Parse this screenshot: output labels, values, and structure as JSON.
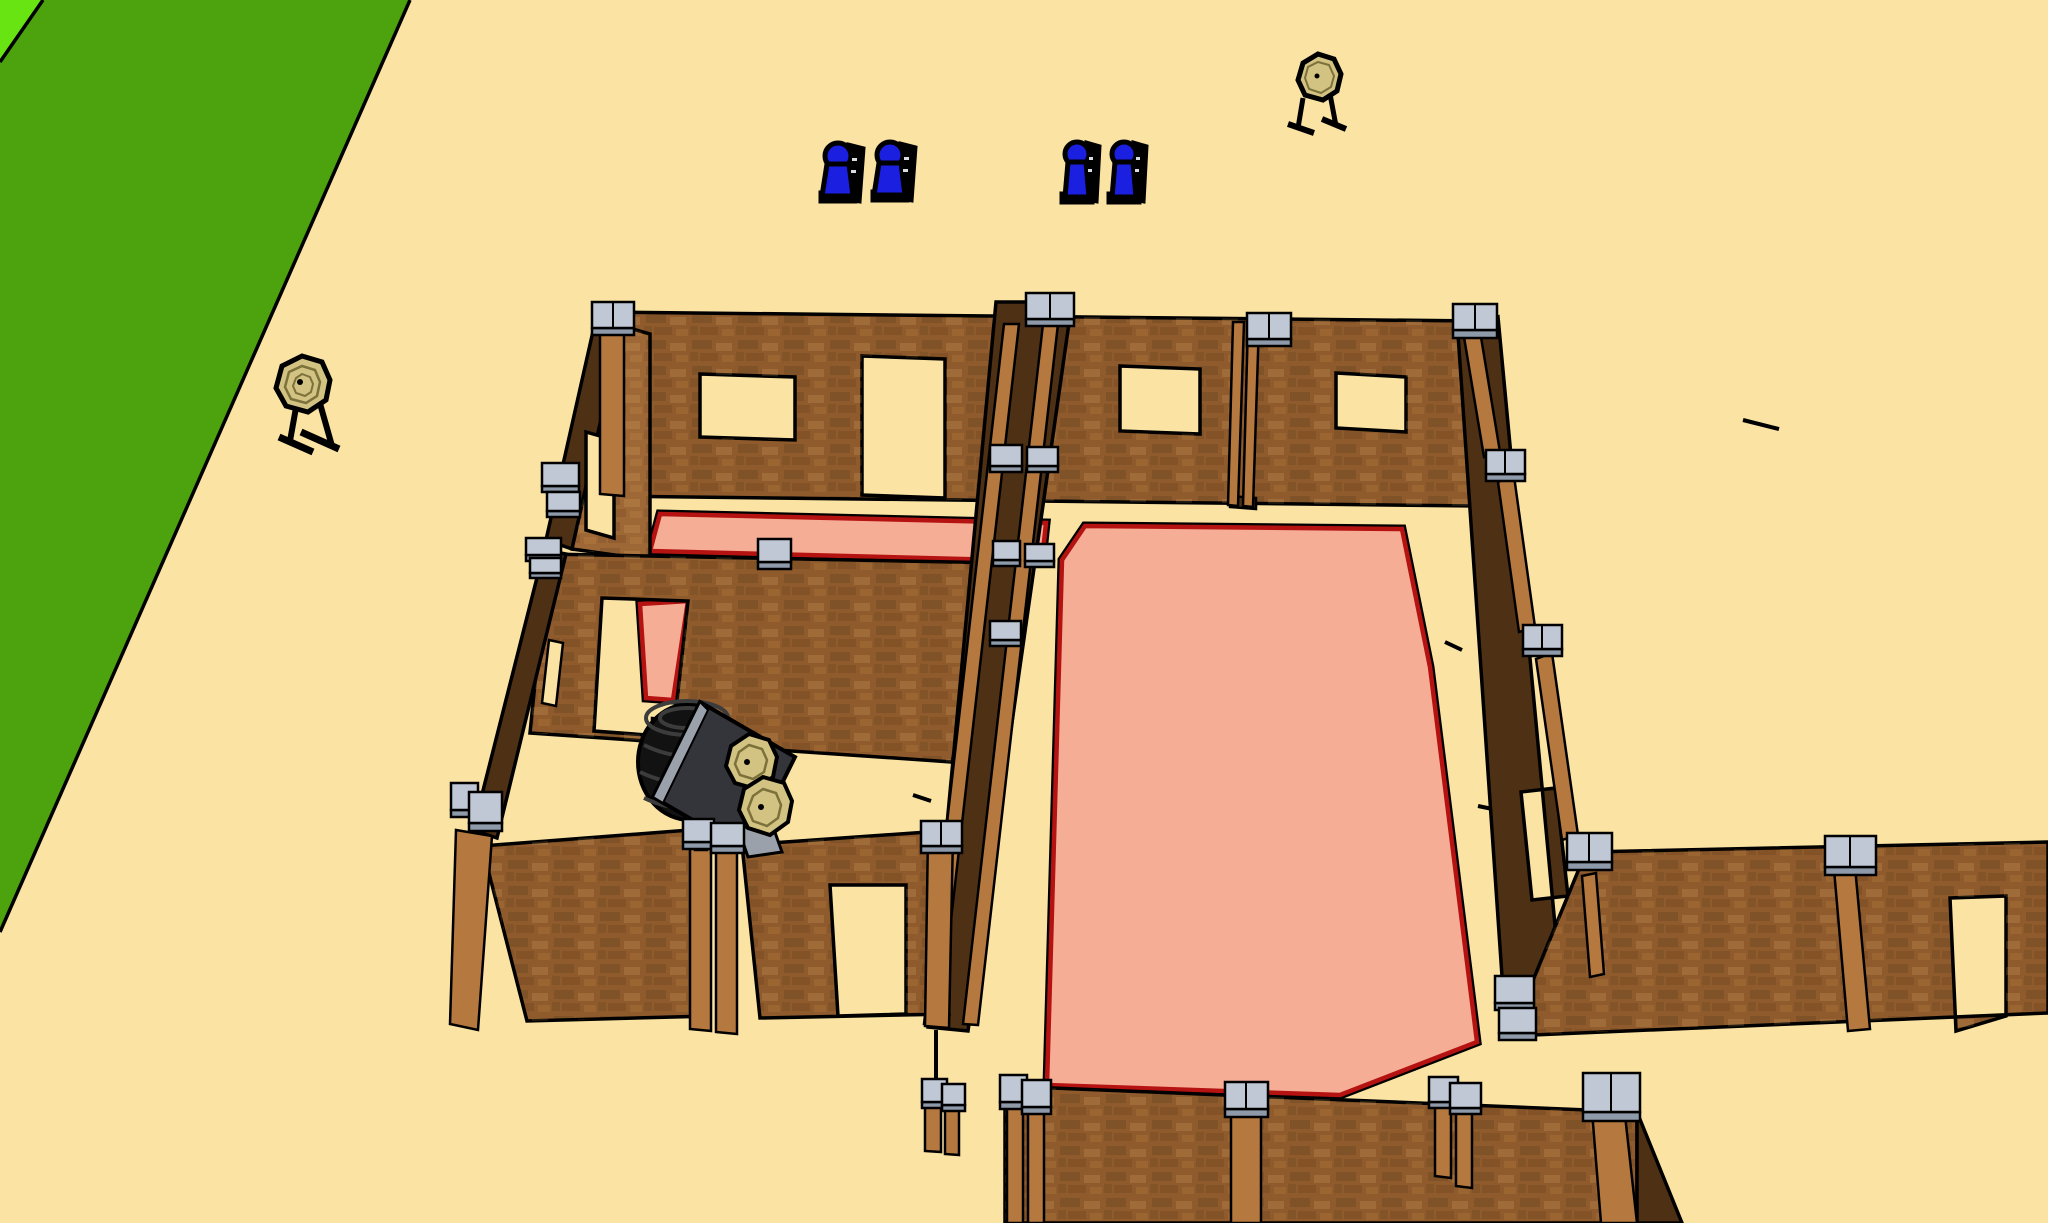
{
  "viewport": {
    "kind": "3d-model-viewport",
    "description": "Overhead perspective 3D model of a pistol shooting stage: wooden walled rooms with window and door openings, steel-capped posts, pink fault-line floor zones outlined in red, two paper targets on stands, four blue steel poppers, a tire stack with a leaning panel holding two paper targets, and a green grass field strip on tan ground."
  },
  "colors": {
    "ground": "#FBE3A4",
    "grass": "#4CA30D",
    "grass_bright": "#69E413",
    "outline": "#000000",
    "wall_face": "#8F5B2D",
    "wall_face_light": "#9D6736",
    "wall_dark": "#4E3015",
    "post": "#B5783E",
    "cap_top": "#BFC8D4",
    "cap_side": "#8E9AAA",
    "floor_fill": "#F6AD96",
    "floor_line": "#B51212",
    "target_face": "#D2C382",
    "target_ring": "#7C713A",
    "popper_blue": "#1A1FE0",
    "panel_dark": "#34343B",
    "panel_edge": "#9BA1AB",
    "tire": "#121212",
    "tire_ridge": "#3C3C3C",
    "white_dot": "#D8DDE3"
  },
  "objects": {
    "paper_target_stands": 2,
    "panel_paper_targets": 2,
    "blue_steel_poppers": 4,
    "tire_stacks": 1,
    "fault_line_floor_zones": 3,
    "walled_rooms": 3
  }
}
